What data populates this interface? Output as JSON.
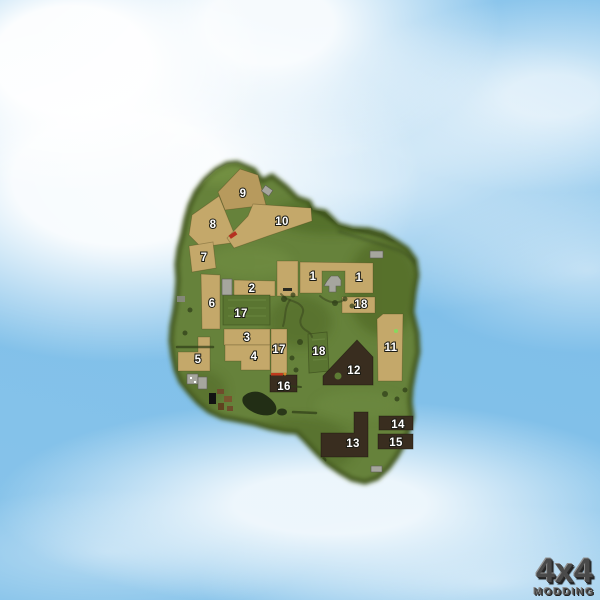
{
  "scene": {
    "description": "Aerial overview map of a green island with numbered farm fields, floating over a blue cloudy sky",
    "watermark": {
      "line1": "4x4",
      "line2": "MODDING"
    }
  },
  "colors": {
    "sky": "#8cc6ec",
    "island": "#66823a",
    "island_edge": "#42561f",
    "field_tan": "#c4a86a",
    "field_tan_dark": "#b79a5d",
    "field_green": "#5a7531",
    "field_dark_brown": "#392d1f",
    "building_gray": "#a6a69e",
    "label_color": "#ffffff",
    "logo_color": "#4a4a4a"
  },
  "map": {
    "field_labels": [
      {
        "label": "9",
        "x": 243,
        "y": 197
      },
      {
        "label": "8",
        "x": 213,
        "y": 228
      },
      {
        "label": "10",
        "x": 282,
        "y": 225
      },
      {
        "label": "7",
        "x": 204,
        "y": 261
      },
      {
        "label": "1",
        "x": 313,
        "y": 280
      },
      {
        "label": "1",
        "x": 359,
        "y": 281
      },
      {
        "label": "2",
        "x": 252,
        "y": 292
      },
      {
        "label": "6",
        "x": 212,
        "y": 307
      },
      {
        "label": "18",
        "x": 361,
        "y": 308
      },
      {
        "label": "17",
        "x": 241,
        "y": 317
      },
      {
        "label": "3",
        "x": 247,
        "y": 341
      },
      {
        "label": "17",
        "x": 279,
        "y": 353
      },
      {
        "label": "18",
        "x": 319,
        "y": 355
      },
      {
        "label": "11",
        "x": 391,
        "y": 351
      },
      {
        "label": "5",
        "x": 198,
        "y": 363
      },
      {
        "label": "4",
        "x": 254,
        "y": 360
      },
      {
        "label": "12",
        "x": 354,
        "y": 374
      },
      {
        "label": "16",
        "x": 284,
        "y": 390
      },
      {
        "label": "13",
        "x": 353,
        "y": 447
      },
      {
        "label": "14",
        "x": 398,
        "y": 428
      },
      {
        "label": "15",
        "x": 396,
        "y": 446
      }
    ]
  }
}
